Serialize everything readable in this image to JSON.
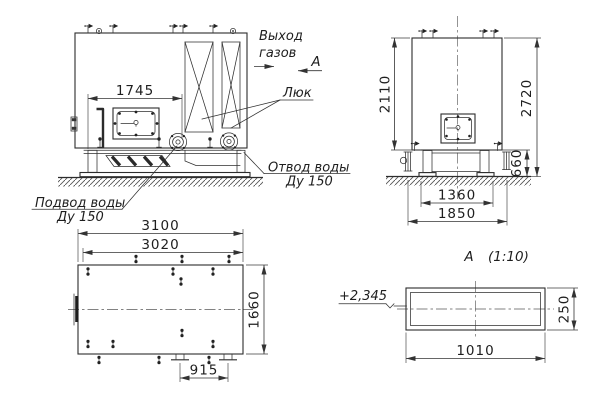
{
  "labels": {
    "gas_outlet_line1": "Выход",
    "gas_outlet_line2": "газов",
    "section_arrow_letter": "А",
    "hatch_label": "Люк",
    "water_outlet_line1": "Отвод воды",
    "water_outlet_line2": "Ду 150",
    "water_supply_line1": "Подвод воды",
    "water_supply_line2": "Ду 150",
    "section_view_letter": "А",
    "section_view_scale": "(1:10)",
    "elevation_mark": "+2,345"
  },
  "dimensions": {
    "front_hatch_to_flange": "1745",
    "side_body_height": "2110",
    "side_total_height": "2720",
    "base_height": "660",
    "base_span_inner": "1360",
    "base_span_outer": "1850",
    "plan_length_overall": "3100",
    "plan_length_body": "3020",
    "plan_width": "1660",
    "drain_spacing": "915",
    "duct_section_width": "1010",
    "duct_section_height": "250"
  },
  "colors": {
    "line": "#2c2c2c",
    "text": "#1e1e1e",
    "background": "#ffffff"
  }
}
